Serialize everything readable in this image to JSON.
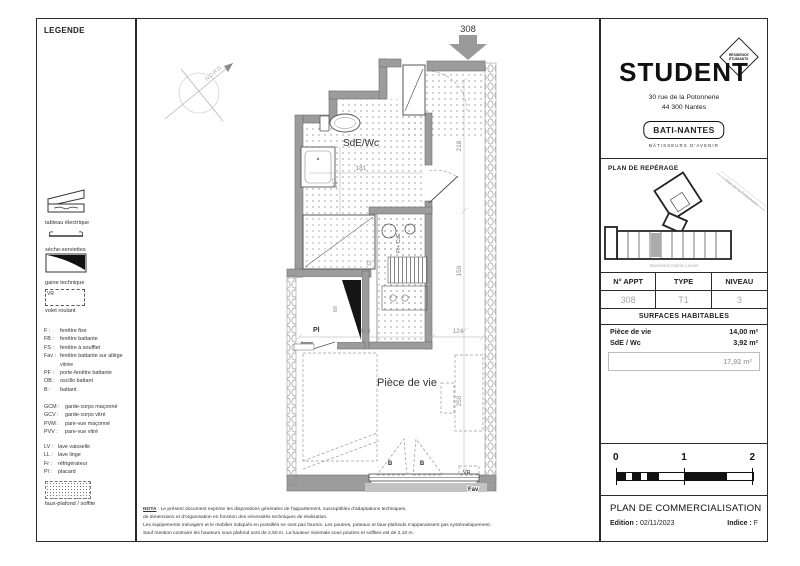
{
  "colors": {
    "wall_gray": "#9c9c9c",
    "value_gray": "#a8a8a8",
    "line_black": "#2b2b2b"
  },
  "legend": {
    "title": "LEGENDE",
    "symbols": [
      {
        "label": "tableau électrique"
      },
      {
        "label": "sèche-serviettes"
      },
      {
        "label": "gaine technique"
      },
      {
        "label": "volet roulant",
        "tag": "VR"
      },
      {
        "label": "faux-plafond / soffite"
      }
    ],
    "abbr_group1": [
      {
        "code": "F :",
        "label": "fenêtre fixe"
      },
      {
        "code": "FB :",
        "label": "fenêtre battante"
      },
      {
        "code": "FS :",
        "label": "fenêtre à soufflet"
      },
      {
        "code": "Fav :",
        "label": "fenêtre battante sur allège vitrée"
      },
      {
        "code": "PF :",
        "label": "porte-fenêtre battante"
      },
      {
        "code": "OB :",
        "label": "oscillo battant"
      },
      {
        "code": "B :",
        "label": "battant"
      }
    ],
    "abbr_group2": [
      {
        "code": "GCM :",
        "label": "garde-corps maçonné"
      },
      {
        "code": "GCV :",
        "label": "garde-corps vitré"
      },
      {
        "code": "PVM :",
        "label": "pare-vue maçonné"
      },
      {
        "code": "PVV :",
        "label": "pare-vue vitré"
      }
    ],
    "abbr_group3": [
      {
        "code": "LV :",
        "label": "lave vaisselle"
      },
      {
        "code": "LL :",
        "label": "lave linge"
      },
      {
        "code": "Fr :",
        "label": "réfrigérateur"
      },
      {
        "code": "Pl :",
        "label": "placard"
      }
    ]
  },
  "plan": {
    "unit_number": "308",
    "north": "NORD",
    "room_sde": "SdE/Wc",
    "room_living": "Pièce de vie",
    "label_pl": "Pl",
    "label_vr": "VR",
    "label_fav": "Fav",
    "label_b_left": "B",
    "label_b_right": "B",
    "label_kitchen": "Fr+ CuE",
    "dims": {
      "d181": "181",
      "d267": "267",
      "d218": "218",
      "d159": "159",
      "d188": "188",
      "d124": "124",
      "d250": "250",
      "d68": "68"
    }
  },
  "nota": {
    "prefix": "NOTA",
    "line1": " : Le présent document exprime les dispositions générales de l'appartement, susceptibles d'adaptations techniques,",
    "line2": "de dimensions et d'organisation en fonction des nécessités techniques de réalisation.",
    "line3": "Les équipements ménagers et le mobilier indiqués en pointillés ne sont pas fournis. Les poutres, poteaux et faux-plafonds n'apparaissent pas systématiquement.",
    "line4": "Sauf mention contraire les hauteurs sous plafond sont de 2,50 m. La hauteur minimale sous poutres et soffites est de 2,10 m."
  },
  "brand": {
    "name": "STUDENT",
    "badge_line1": "RÉSIDENCE",
    "badge_line2": "ÉTUDIANTS",
    "address_line1": "30 rue de la Potonnerie",
    "address_line2": "44 300 Nantes",
    "builder": "BATI-NANTES",
    "tagline": "BÂTISSEURS D'AVENIR"
  },
  "reperage": {
    "title": "PLAN DE REPÉRAGE",
    "street_top": "Rue de la Potonnerie",
    "street_bottom": "Boulevard Gabriel Lauriol"
  },
  "info": {
    "headers": [
      "N° APPT",
      "TYPE",
      "NIVEAU"
    ],
    "values": [
      "308",
      "T1",
      "3"
    ]
  },
  "surfaces": {
    "title": "SURFACES HABITABLES",
    "rows": [
      {
        "label": "Pièce de vie",
        "value": "14,00 m²"
      },
      {
        "label": "SdE / Wc",
        "value": "3,92 m²"
      }
    ],
    "total": "17,92 m²"
  },
  "scale": {
    "t0": "0",
    "t1": "1",
    "t2": "2"
  },
  "footer": {
    "title": "PLAN DE COMMERCIALISATION",
    "edition_label": "Edition :",
    "edition_value": "02/11/2023",
    "indice_label": "Indice :",
    "indice_value": "F"
  }
}
